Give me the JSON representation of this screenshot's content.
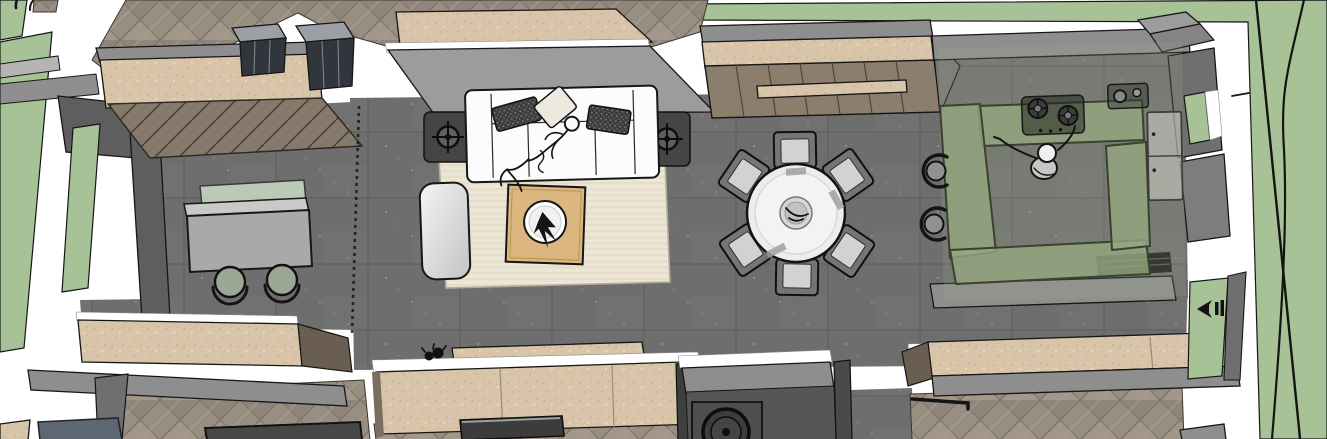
{
  "labels": {
    "viewport": "3D top-down floor plan render",
    "lawn": "garden lawn",
    "walkway": "white walkway",
    "living_sofa": "white three-seat sofa",
    "pillow": "throw pillow",
    "person_lounging": "sketch person lounging on sofa",
    "area_rug": "cream area rug",
    "coffee_table": "wooden coffee table",
    "decor_bowl": "round decor bowl with plant",
    "armchair": "lounge armchair",
    "floor_lamp": "floor lamp symbol",
    "side_table": "dark side table",
    "dining_table": "round dining table",
    "dining_chair": "dining chair",
    "centerpiece": "table centerpiece bowl",
    "media_wall": "wood slat media feature wall",
    "kitchen_counter": "U-shaped kitchen counter (glass-green)",
    "cooktop": "two-burner gas cooktop",
    "sink": "kitchen sink unit",
    "fridge": "refrigerator",
    "person_cooking": "sketch person standing in kitchen",
    "bar_stool": "bar stool",
    "study_desk": "study desk with glass divider",
    "desk_chair": "round desk chair",
    "cabinet": "dark glass display cabinet",
    "washer": "washing machine",
    "bed_blue": "blue-gray bed",
    "bed_dark": "dark bed frame",
    "console": "media console",
    "wardrobe_wall": "beige wardrobe wall",
    "plant": "small plant silhouette",
    "tap_icon": "outdoor-tap-icon",
    "window": "window opening",
    "steps": "entry steps",
    "tree": "tree branch outline",
    "partition": "dashed partition track",
    "vent": "dark floor vent grille",
    "rail": "black wardrobe rail"
  },
  "scene": {
    "people_count": 2,
    "dining_chairs": 6,
    "bar_stools": 2,
    "desk_chairs": 2,
    "floor_lamps": 2,
    "cooktop_burners": 2,
    "display_cabinets": 2,
    "washing_machines": 1
  },
  "colors": {
    "lawn": "#a7c296",
    "walkway": "#ffffff",
    "tile_floor": "#6e6e6e",
    "wood_floor": "#998e82",
    "beige_wall": "#d8c5a9",
    "slat_wall": "#8b7e6c",
    "gray_wall": "#8e8e8e",
    "gray_wall_dark": "#5e5e5e",
    "sofa": "#fcfcfc",
    "pillow_dark": "#3d3d3d",
    "rug": "#ebe4d2",
    "coffee_table": "#dbb67f",
    "kitchen_glass": "#95a77f",
    "outline": "#161616"
  }
}
